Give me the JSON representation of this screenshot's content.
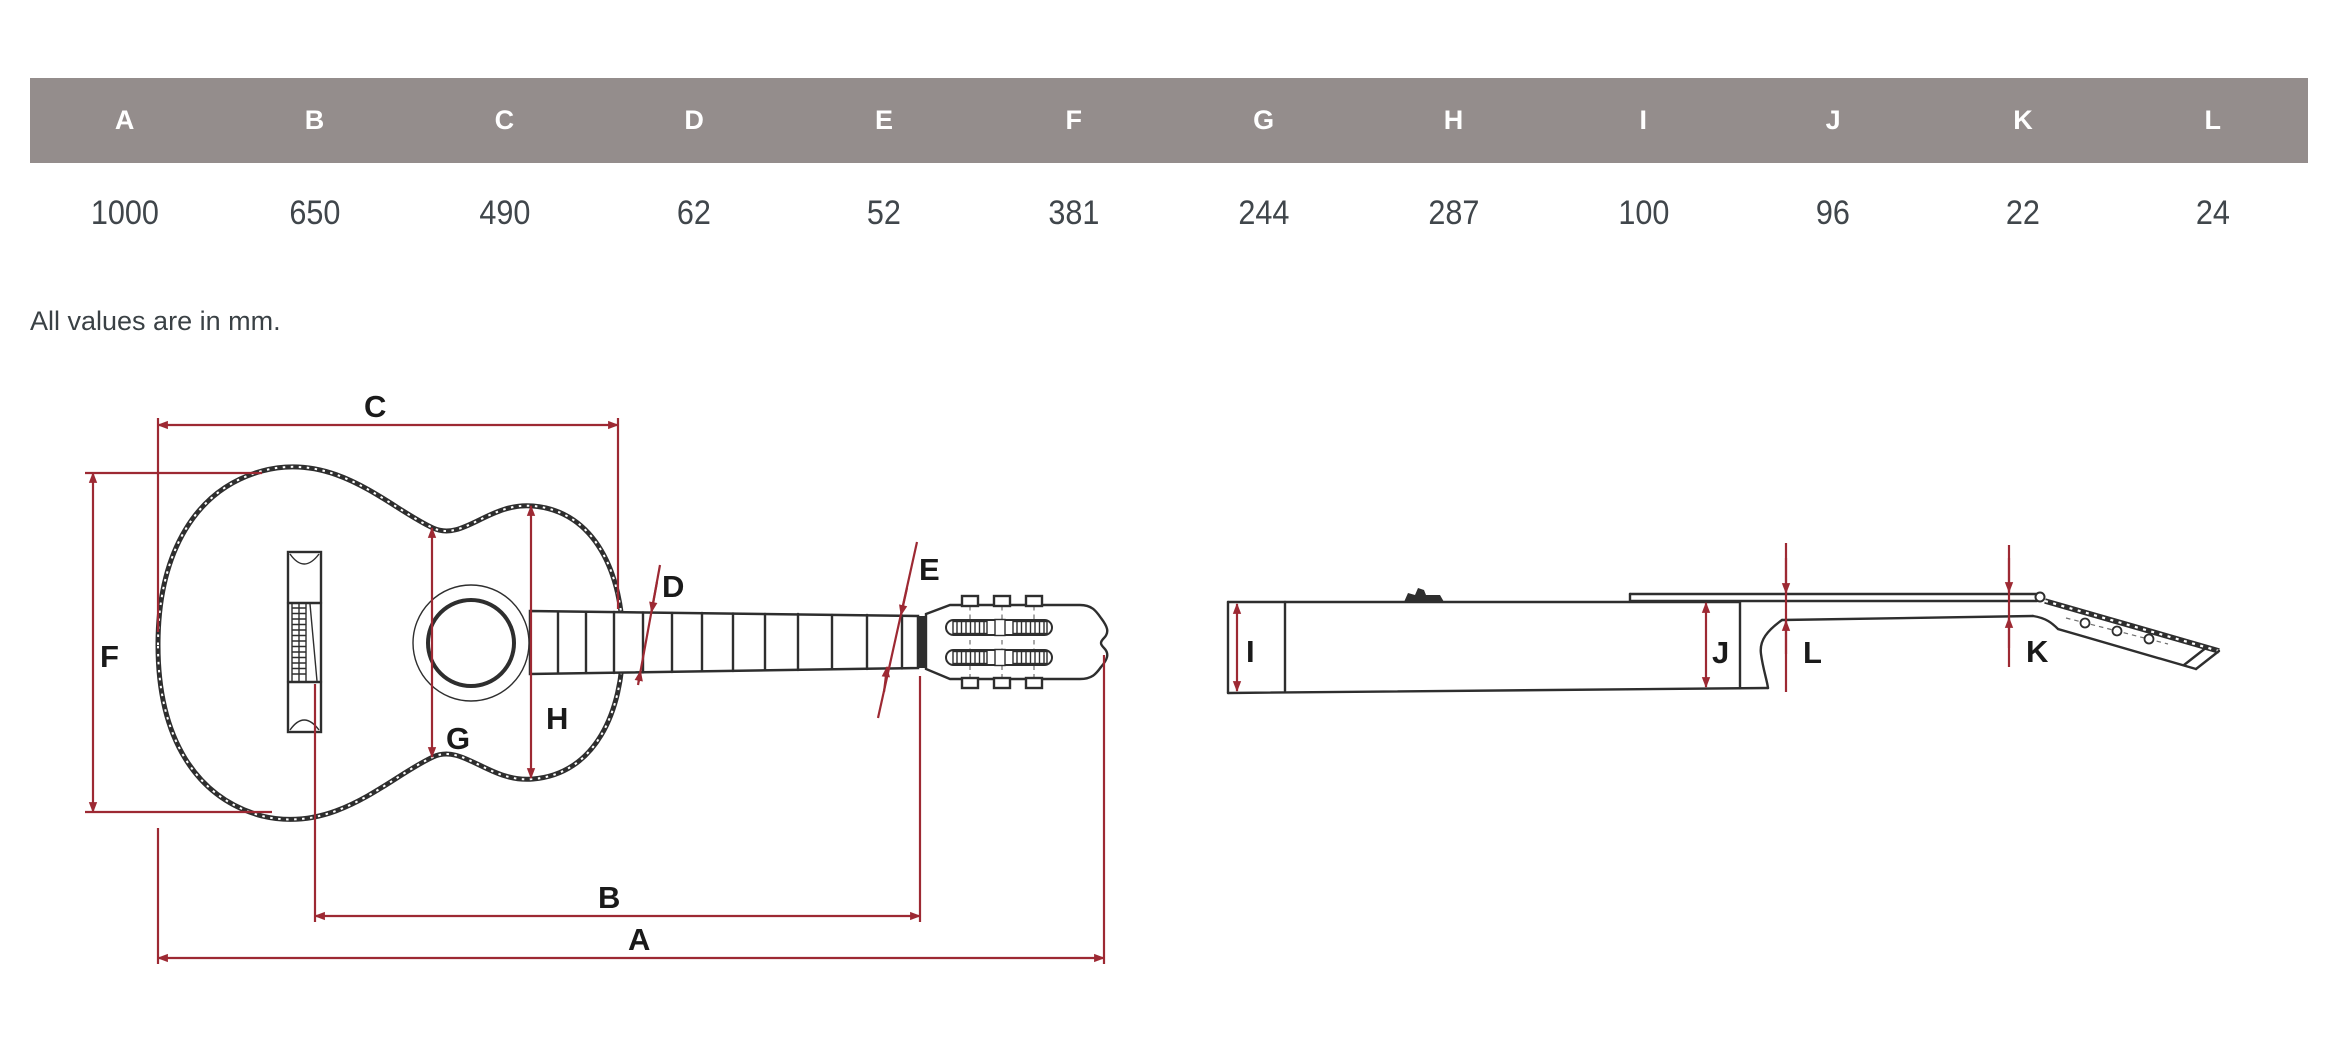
{
  "table": {
    "columns": [
      {
        "label": "A",
        "value": "1000"
      },
      {
        "label": "B",
        "value": "650"
      },
      {
        "label": "C",
        "value": "490"
      },
      {
        "label": "D",
        "value": "62"
      },
      {
        "label": "E",
        "value": "52"
      },
      {
        "label": "F",
        "value": "381"
      },
      {
        "label": "G",
        "value": "244"
      },
      {
        "label": "H",
        "value": "287"
      },
      {
        "label": "I",
        "value": "100"
      },
      {
        "label": "J",
        "value": "96"
      },
      {
        "label": "K",
        "value": "22"
      },
      {
        "label": "L",
        "value": "24"
      }
    ]
  },
  "note": "All values are in mm.",
  "diagram": {
    "labels": {
      "a": "A",
      "b": "B",
      "c": "C",
      "d": "D",
      "e": "E",
      "f": "F",
      "g": "G",
      "h": "H",
      "i": "I",
      "j": "J",
      "k": "K",
      "l": "L"
    }
  },
  "colors": {
    "table_header_bg": "#948D8C",
    "table_header_text": "#FFFFFF",
    "value_text": "#40464B",
    "dimension_line": "#9D2933",
    "drawing_line": "#2E2E2E"
  }
}
